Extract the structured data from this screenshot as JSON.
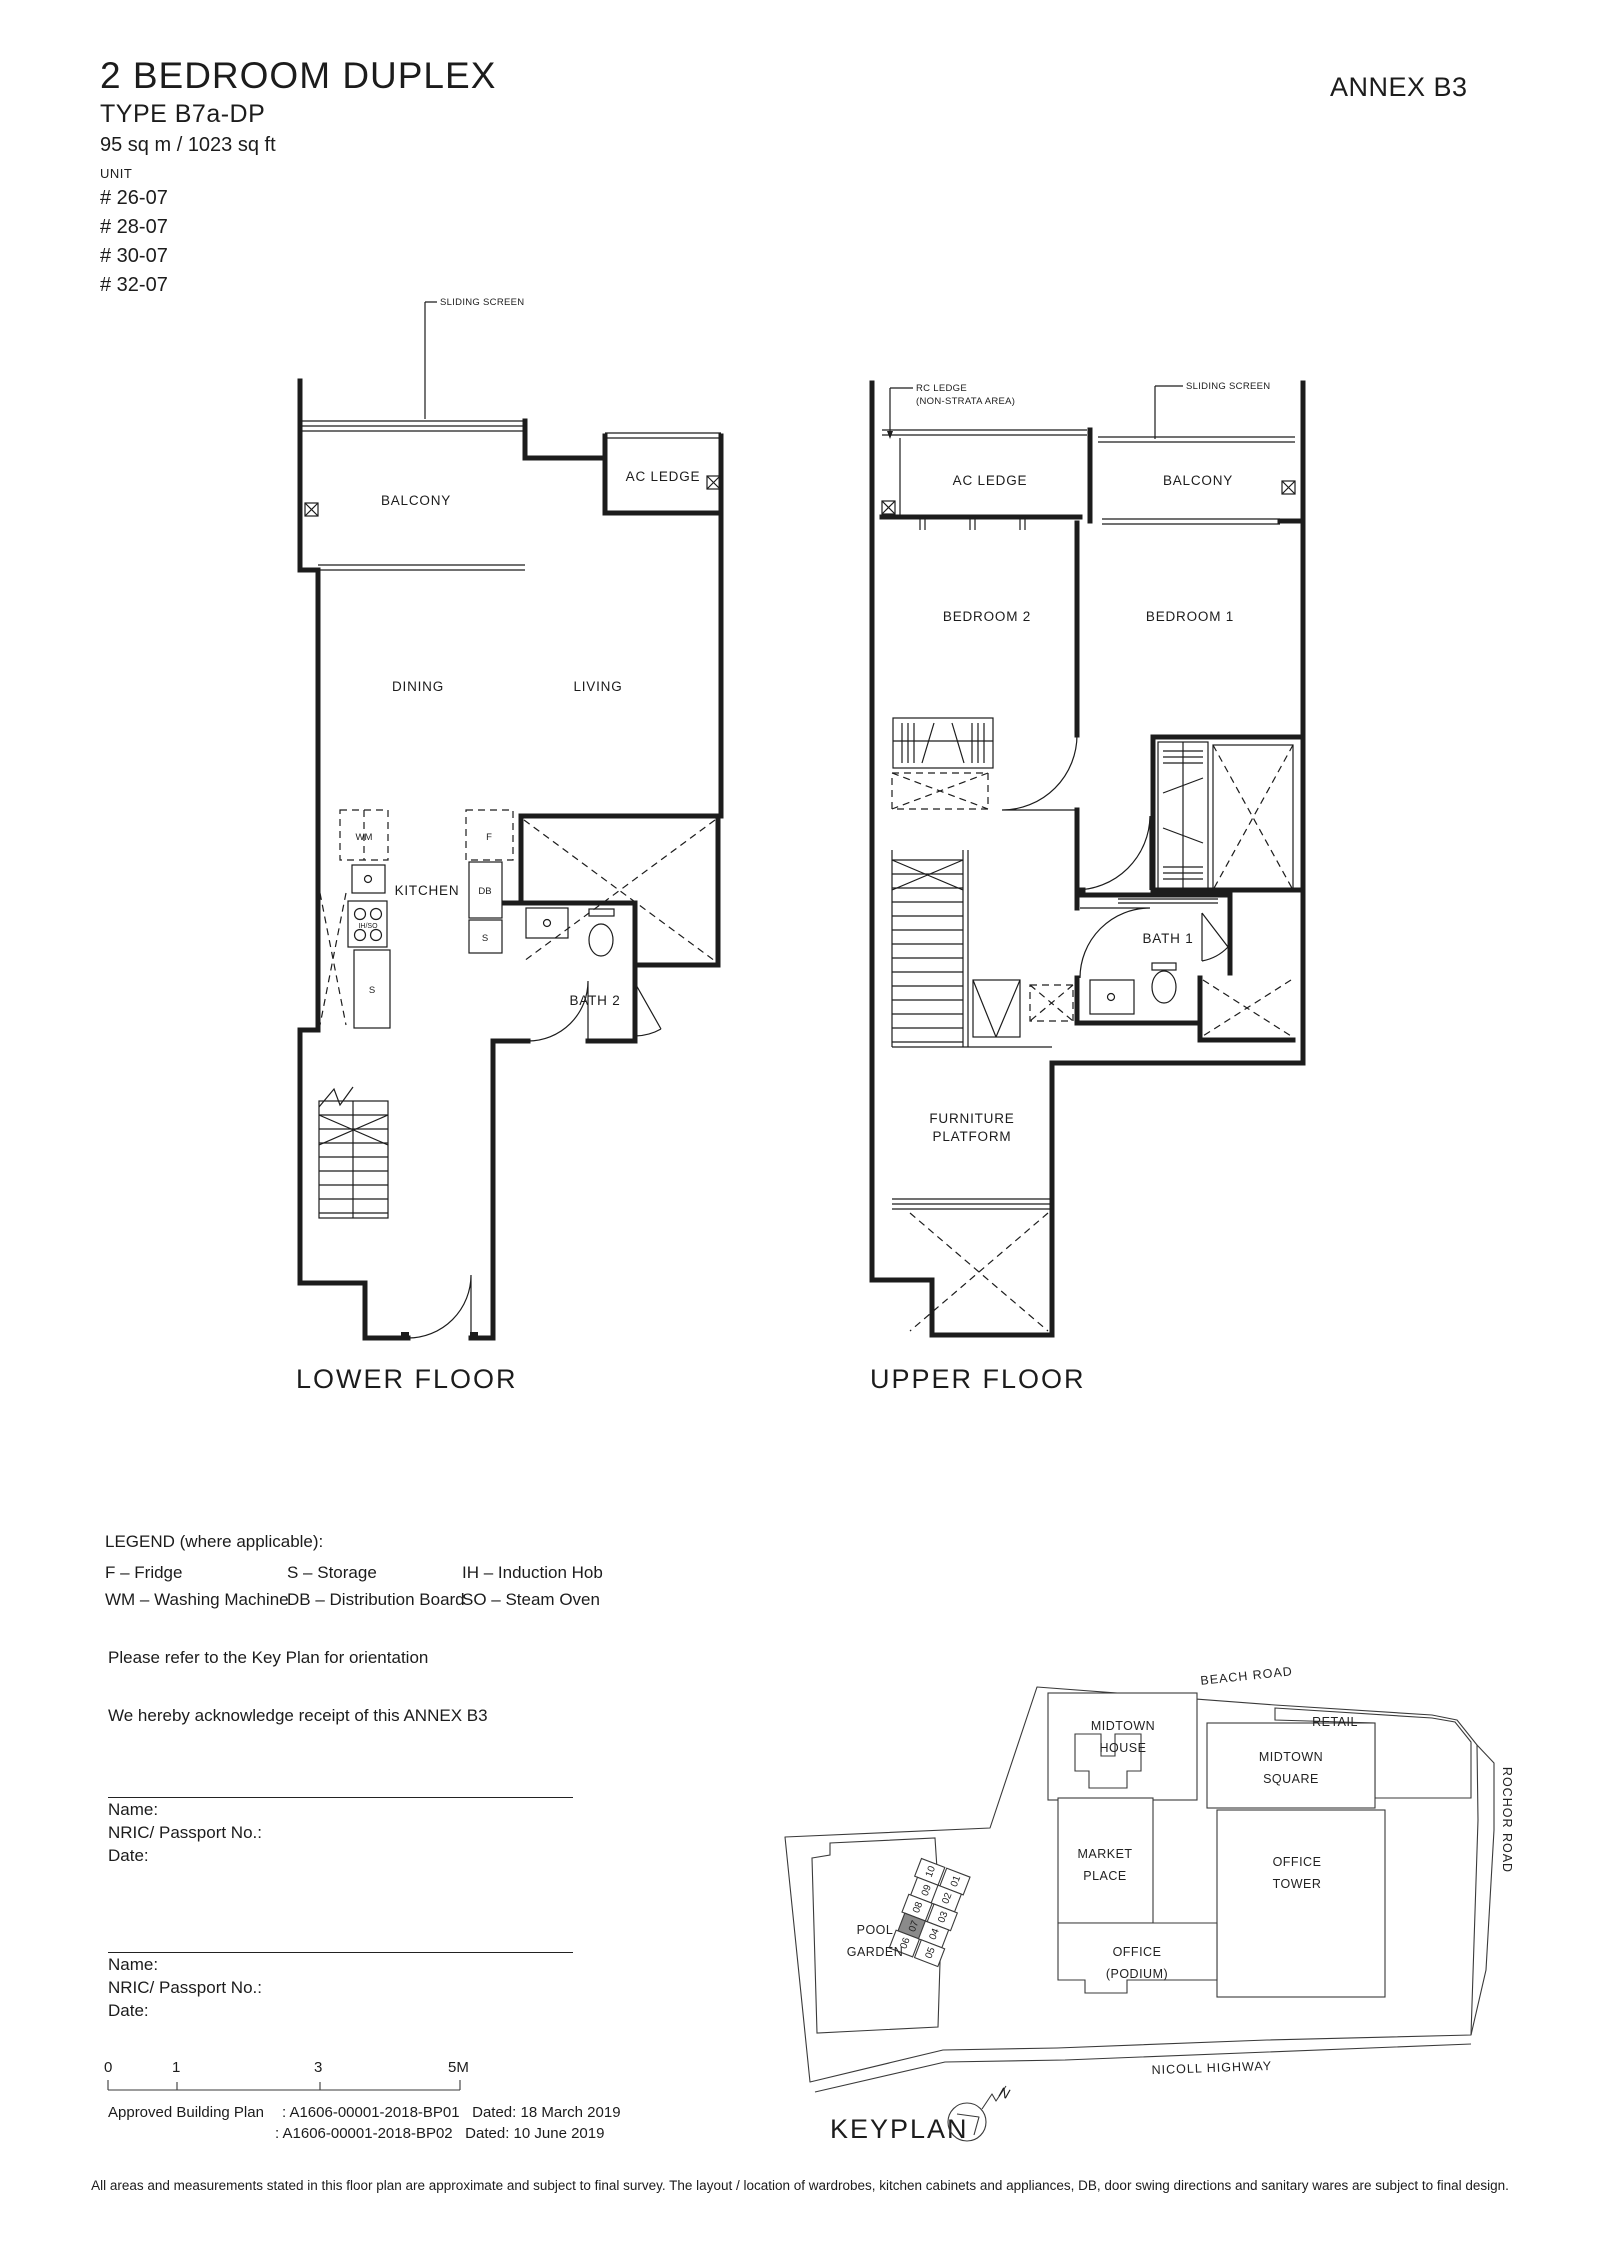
{
  "header": {
    "title": "2 BEDROOM DUPLEX",
    "type": "TYPE B7a-DP",
    "area": "95 sq m / 1023 sq ft",
    "unit_label": "UNIT",
    "units": [
      "# 26-07",
      "# 28-07",
      "# 30-07",
      "# 32-07"
    ],
    "annex": "ANNEX B3"
  },
  "lower_floor": {
    "name": "LOWER FLOOR",
    "rooms": {
      "balcony": "BALCONY",
      "ac_ledge": "AC LEDGE",
      "dining": "DINING",
      "living": "LIVING",
      "kitchen": "KITCHEN",
      "bath2": "BATH 2"
    },
    "labels": {
      "sliding_screen": "SLIDING SCREEN",
      "wm": "WM",
      "f": "F",
      "db": "DB",
      "s1": "S",
      "s2": "S",
      "ihso": "IH/SO"
    }
  },
  "upper_floor": {
    "name": "UPPER FLOOR",
    "rooms": {
      "ac_ledge": "AC LEDGE",
      "balcony": "BALCONY",
      "bedroom2": "BEDROOM 2",
      "bedroom1": "BEDROOM 1",
      "bath1": "BATH 1",
      "furniture1": "FURNITURE",
      "furniture2": "PLATFORM"
    },
    "labels": {
      "rc_ledge1": "RC LEDGE",
      "rc_ledge2": "(NON-STRATA AREA)",
      "sliding_screen": "SLIDING SCREEN"
    }
  },
  "legend": {
    "title": "LEGEND (where applicable):",
    "col1": [
      "F – Fridge",
      "WM – Washing Machine"
    ],
    "col2": [
      "S – Storage",
      "DB – Distribution Board"
    ],
    "col3": [
      "IH – Induction Hob",
      "SO – Steam Oven"
    ]
  },
  "notes": {
    "keyplan": "Please refer to the Key Plan for orientation",
    "ack": "We hereby acknowledge receipt of this ANNEX B3"
  },
  "signature": {
    "fields": [
      "Name:",
      "NRIC/ Passport No.:",
      "Date:"
    ]
  },
  "scale": {
    "ticks": [
      "0",
      "1",
      "3",
      "5M"
    ]
  },
  "approval": {
    "label": "Approved Building Plan",
    "rows": [
      {
        "no": ": A1606-00001-2018-BP01",
        "date": "Dated: 18 March 2019"
      },
      {
        "no": ": A1606-00001-2018-BP02",
        "date": "Dated: 10 June 2019"
      }
    ]
  },
  "keyplan": {
    "title": "KEYPLAN",
    "north": "N",
    "roads": {
      "beach": "BEACH ROAD",
      "nicoll": "NICOLL HIGHWAY",
      "rochor": "ROCHOR ROAD"
    },
    "buildings": {
      "mh1": "MIDTOWN",
      "mh2": "HOUSE",
      "retail": "RETAIL",
      "ms1": "MIDTOWN",
      "ms2": "SQUARE",
      "mp1": "MARKET",
      "mp2": "PLACE",
      "ot1": "OFFICE",
      "ot2": "TOWER",
      "op1": "OFFICE",
      "op2": "(PODIUM)",
      "pg1": "POOL",
      "pg2": "GARDEN"
    },
    "units": [
      "01",
      "02",
      "03",
      "04",
      "05",
      "06",
      "07",
      "08",
      "09",
      "10"
    ],
    "highlighted_unit": "07",
    "highlight_color": "#8a8a8a"
  },
  "disclaimer": "All areas and measurements stated in this floor plan are approximate and subject to final survey. The layout / location of wardrobes, kitchen cabinets and appliances, DB, door swing directions and sanitary wares are subject to final design."
}
